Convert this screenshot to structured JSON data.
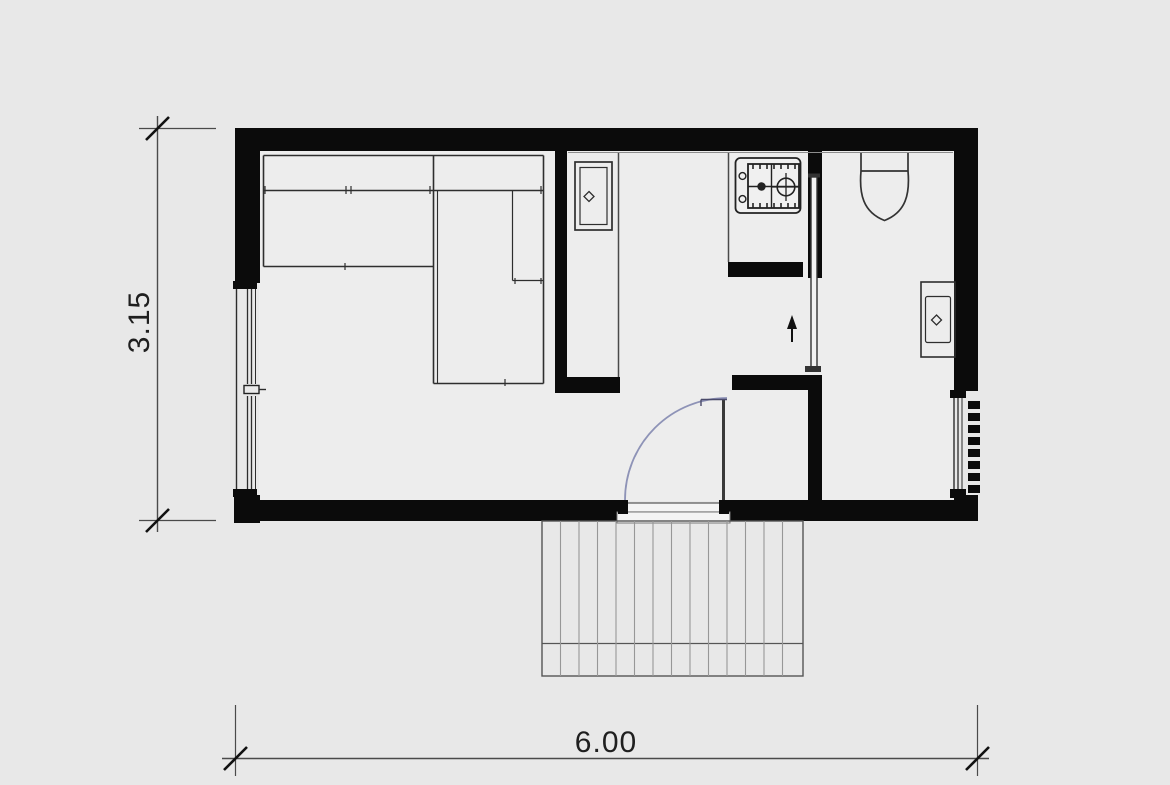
{
  "drawing": {
    "type": "architectural floor plan",
    "scale_note": "plan of a small cabin module"
  },
  "dimensions": {
    "width_meters": "6.00",
    "height_meters": "3.15"
  },
  "fixtures": [
    "corner-sofa",
    "tall-cabinet-with-sink",
    "gas-hob-two-burners",
    "sliding-door",
    "entrance-door-with-swing-arc",
    "toilet",
    "washbasin",
    "window-left",
    "window-right-with-vent-grille",
    "wood-deck"
  ],
  "colors": {
    "background": "#e8e8e8",
    "interior_floor": "#ededed",
    "wall": "#0b0b0b",
    "line": "#333333",
    "thin_line": "#555555",
    "deck_line": "#8f8f8f",
    "door_arc": "#7d82ad",
    "dimension_text": "#1f1f1f"
  }
}
